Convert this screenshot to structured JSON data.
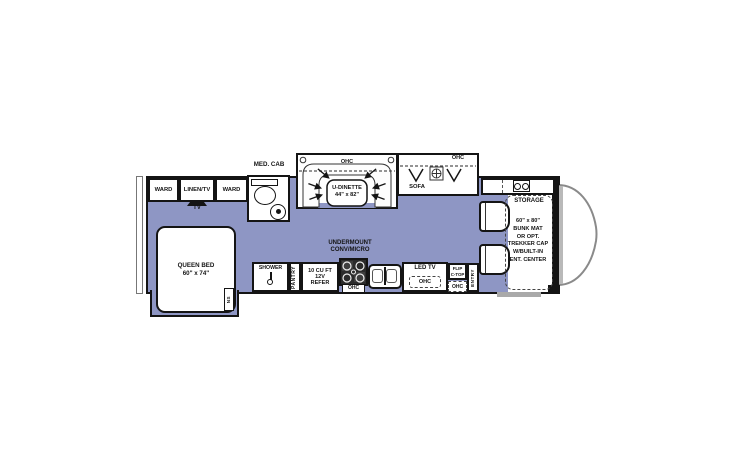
{
  "colors": {
    "floor": "#8e96c4",
    "wall": "#141414",
    "hood_line": "#8a8a8a"
  },
  "labels": {
    "ward_left": "WARD",
    "linen_tv": "LINEN/TV",
    "ward_right": "WARD",
    "tv": "TV",
    "med_cab": "MED. CAB",
    "queen_bed": "QUEEN BED\n60\" x 74\"",
    "nightstand": "NS",
    "shower": "SHOWER",
    "pantry": "PANTRY",
    "refer": "10 CU FT\n12V\nREFER",
    "undermount_conv": "UNDERMOUNT\nCONV/MICRO",
    "ohc": "OHC",
    "u_dinette": "U-DINETTE\n44\" x 82\"",
    "sofa": "SOFA",
    "led_tv": "LED TV",
    "flip_ctop": "FLIP\nC-TOP",
    "entry": "ENTRY",
    "storage": "STORAGE",
    "bunk": "60\" x 80\"\nBUNK MAT\nOR OPT.\nTREKKER CAP\nW/BUILT-IN\nENT. CENTER"
  }
}
